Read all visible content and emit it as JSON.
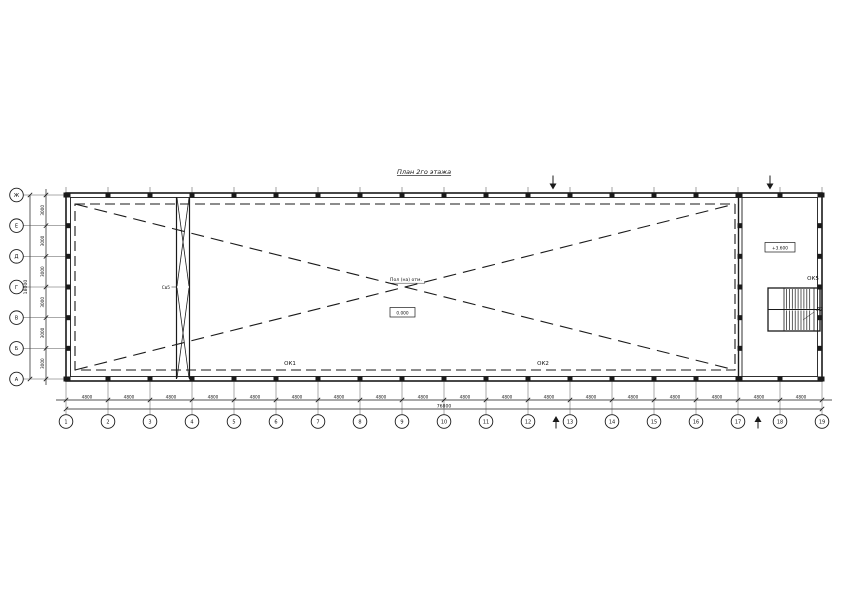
{
  "title": "План 2го этажа",
  "axes_horizontal": {
    "numbers": [
      "1",
      "2",
      "3",
      "4",
      "5",
      "6",
      "7",
      "8",
      "9",
      "10",
      "11",
      "12",
      "13",
      "14",
      "15",
      "16",
      "17",
      "18",
      "19"
    ],
    "bay_dims": [
      "4800",
      "4800",
      "4800",
      "4800",
      "4800",
      "4800",
      "4800",
      "4800",
      "4800",
      "4800",
      "4800",
      "4800",
      "4800",
      "4800",
      "4800",
      "4800",
      "4800",
      "4800"
    ],
    "total_dim": "76800"
  },
  "axes_vertical": {
    "letters": [
      "Ж",
      "Е",
      "Д",
      "Г",
      "В",
      "Б",
      "А"
    ],
    "bay_dims": [
      "3000",
      "3000",
      "3000",
      "3000",
      "3000",
      "3000"
    ],
    "total_dim": "18000"
  },
  "annotations": {
    "opening_note": "Пол (на) отм.",
    "opening_level": "0.000",
    "stair_level": "+3.600",
    "window_left": "ОК1",
    "window_right": "ОК2",
    "stair_window": "ОК5",
    "stair_label": "Л2",
    "brace_label": "Св5"
  },
  "colors": {
    "line": "#1a1a1a",
    "background": "#ffffff"
  }
}
